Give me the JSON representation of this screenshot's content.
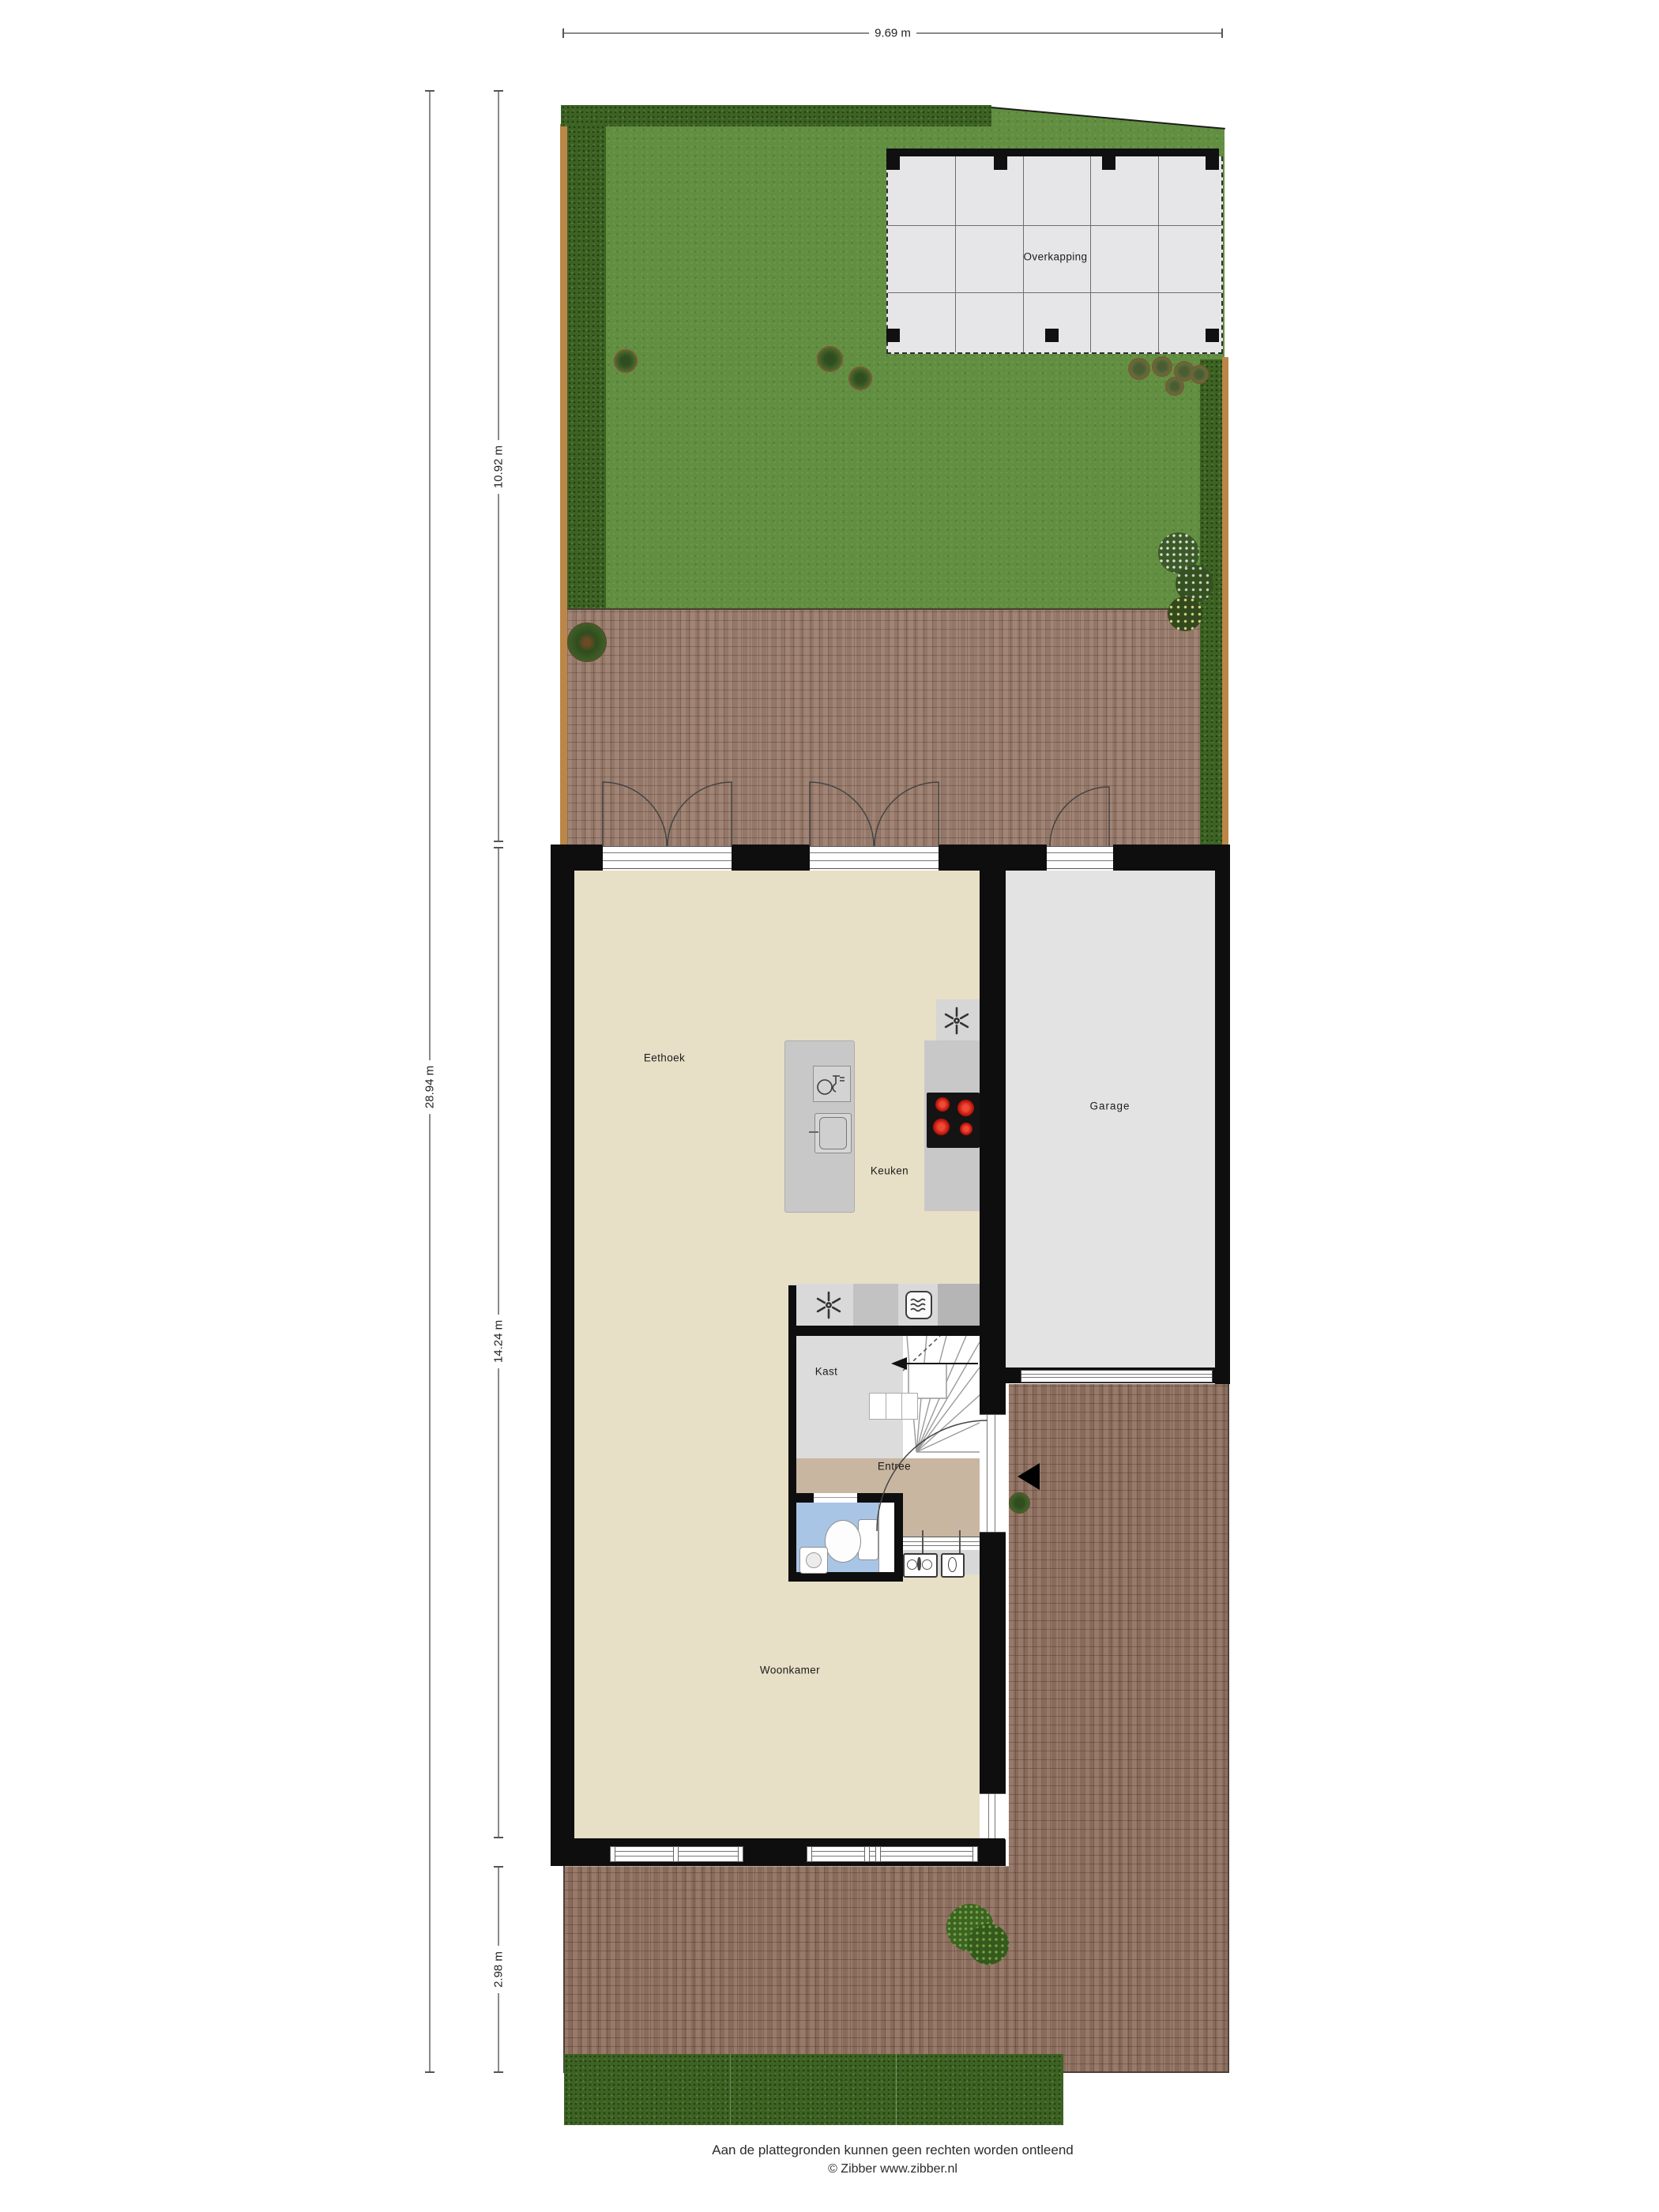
{
  "dimensions": {
    "top": "9.69 m",
    "garden_depth": "10.92 m",
    "plot_depth": "28.94 m",
    "house_depth": "14.24 m",
    "patio_depth": "2.98 m"
  },
  "rooms": {
    "overkapping": "Overkapping",
    "eethoek": "Eethoek",
    "keuken": "Keuken",
    "garage": "Garage",
    "kast": "Kast",
    "entree": "Entree",
    "woonkamer": "Woonkamer"
  },
  "footer": {
    "disclaimer": "Aan de plattegronden kunnen geen rechten worden ontleend",
    "copyright": "© Zibber www.zibber.nl"
  },
  "icons": {
    "extractor_fan": "six-blade-fan",
    "microwave": "oven-with-waves",
    "dishwasher": "plate-and-glass",
    "sink": "basin-with-tap",
    "hob": "four-red-burners",
    "toilet": "bowl-and-cistern",
    "washbasin": "small-basin",
    "stair_arrow": "left-triangle",
    "entrance_arrow": "left-triangle"
  },
  "colors": {
    "wall": "#0e0e0e",
    "floor_main": "#e7dfc6",
    "floor_garage": "#e3e3e3",
    "floor_kast": "#dcdcdc",
    "floor_entree": "#c9b6a1",
    "floor_toilet": "#a9c5e6",
    "grass": "#618e40",
    "hedge": "#3d6323",
    "fence": "#bb8648",
    "brick": "#9c7e6e",
    "canopy": "#e6e6e9",
    "burner_red": "#d92b20"
  }
}
